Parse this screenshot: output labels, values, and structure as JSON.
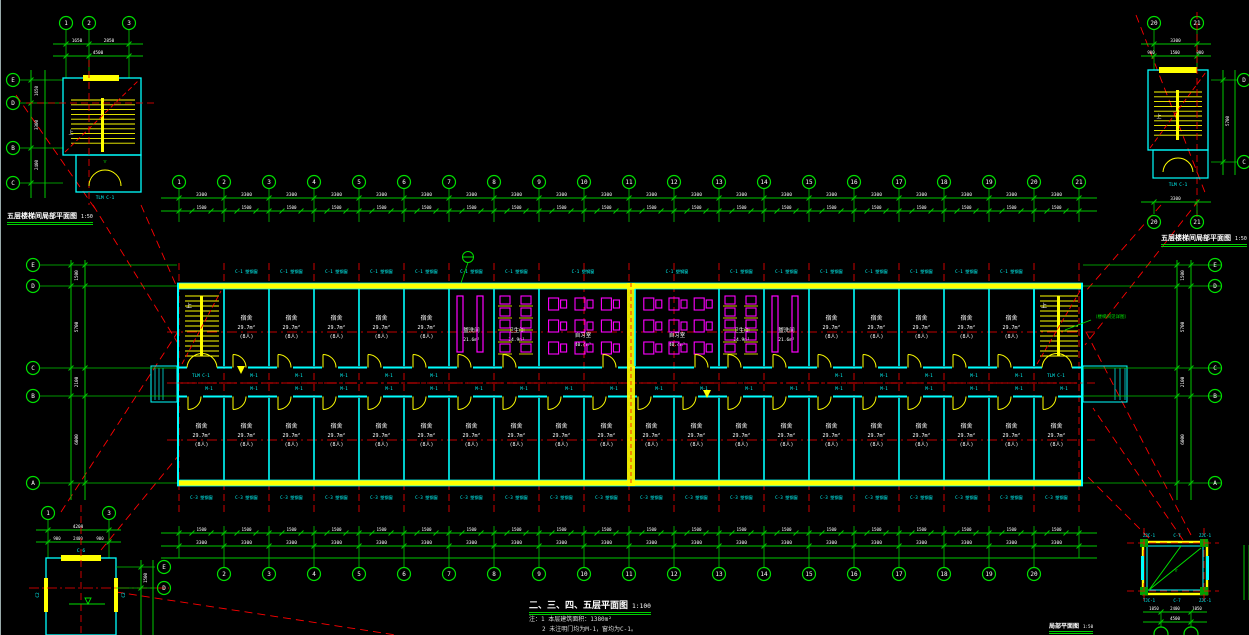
{
  "canvas": {
    "w": 1249,
    "h": 635,
    "bg": "#000000"
  },
  "colors": {
    "axis_red": "#ff0000",
    "dim_green": "#00c800",
    "bubble_green": "#00e000",
    "wall_cyan": "#00ffff",
    "fitting_yellow": "#ffff00",
    "fixture_magenta": "#ff00ff",
    "text_white": "#ffffff"
  },
  "titles": {
    "main_title": "二、三、四、五层平面图",
    "main_scale": "1:100",
    "note1": "注：1 本层建筑面积：1380m²",
    "note2": "2 未注明门均为M-1，窗均为C-1。",
    "stair_tl": "五层楼梯间局部平面图",
    "stair_tl_scale": "1:50",
    "stair_tr": "五层楼梯间局部平面图",
    "stair_tr_scale": "1:50",
    "br_title": "局部平面图",
    "br_scale": "1:50"
  },
  "axes": {
    "top": [
      "1",
      "2",
      "3",
      "4",
      "5",
      "6",
      "7",
      "8",
      "9",
      "10",
      "11",
      "12",
      "13",
      "14",
      "15",
      "16",
      "17",
      "18",
      "19",
      "20",
      "21"
    ],
    "bottom": [
      "2",
      "3",
      "4",
      "5",
      "6",
      "7",
      "8",
      "9",
      "10",
      "11",
      "12",
      "13",
      "14",
      "15",
      "16",
      "17",
      "18",
      "19",
      "20"
    ],
    "left": [
      "E",
      "D",
      "C",
      "B",
      "A"
    ],
    "right": [
      "E",
      "D",
      "C",
      "B",
      "A"
    ]
  },
  "details": {
    "tl": {
      "top": [
        "1",
        "2",
        "3"
      ],
      "left": [
        "E",
        "D",
        "B",
        "C"
      ],
      "dims_t1": [
        "1650",
        "2850"
      ],
      "dim_t2": "4500",
      "dims_lv": [
        "1650",
        "3300",
        "2400"
      ]
    },
    "tr": {
      "top": [
        "20",
        "21"
      ],
      "bottom": [
        "20",
        "21"
      ],
      "right": [
        "D",
        "C"
      ],
      "dim_t1": "3300",
      "dims_t2": [
        "900",
        "1500",
        "900"
      ],
      "dim_rv": "5700"
    },
    "bl": {
      "top": [
        "1",
        "3"
      ],
      "right": [
        "E",
        "D"
      ],
      "dim_t1": "4200",
      "dims_t2": [
        "900",
        "2400",
        "900"
      ],
      "dim_rv": "1500"
    },
    "br": {
      "tags_top": [
        "ZJC-1",
        "C-7",
        "ZJC-1"
      ],
      "tags_bottom": [
        "TJC-1",
        "C-7",
        "ZJC-1"
      ],
      "dims_t1": [
        "1050",
        "2400",
        "1050"
      ],
      "dim_t2": "4500"
    }
  },
  "dims": {
    "bay": "3300",
    "win": "1500",
    "left_v": [
      "1500",
      "5700",
      "2100",
      "6000"
    ],
    "right_v": [
      "1500",
      "5700",
      "2100",
      "6000"
    ]
  },
  "plan": {
    "upper_sequence": [
      "stair",
      "dorm",
      "dorm",
      "dorm",
      "dorm",
      "dorm",
      "wash",
      "toilet",
      "study",
      "joint",
      "study",
      "toilet",
      "wash",
      "dorm",
      "dorm",
      "dorm",
      "dorm",
      "dorm",
      "stair"
    ],
    "lower_room_count": 20
  },
  "rooms": {
    "dorm": {
      "name": "宿舍",
      "area": "29.7m²",
      "occ": "(8人)"
    },
    "study": {
      "name": "自习室",
      "area": "40.4m²"
    },
    "toilet": {
      "name": "卫生间",
      "area": "14.9m²"
    },
    "wash": {
      "name": "盥洗间",
      "area": "21.6m²"
    },
    "stair_up": "上"
  },
  "tags": {
    "win_upper": "C-1 塑钢窗",
    "win_lower": "C-3 塑钢窗",
    "door": "M-1",
    "stair_door": "TLM C-1",
    "c6": "C-6",
    "c2": "C2"
  },
  "annotations": {
    "stair_note": "（楼梯间见详图）"
  }
}
